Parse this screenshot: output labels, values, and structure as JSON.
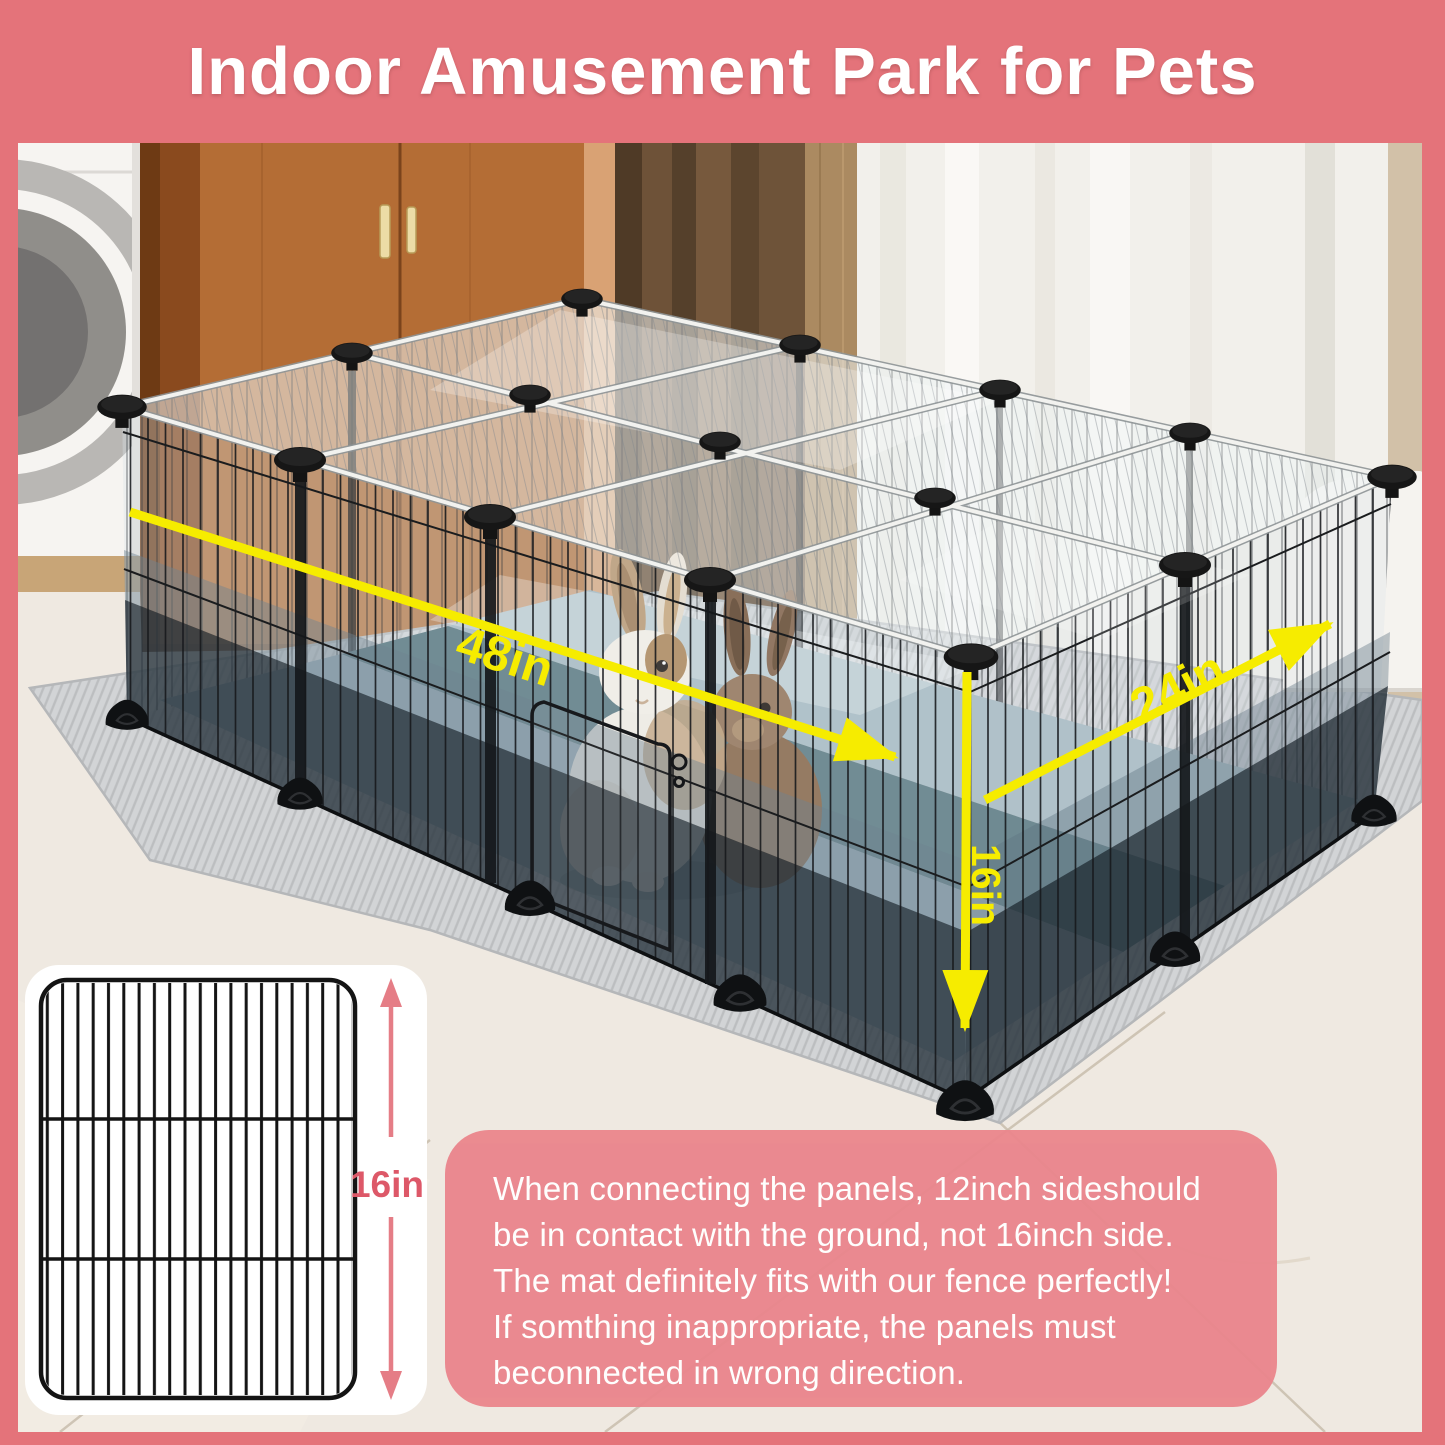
{
  "header": {
    "title": "Indoor Amusement Park for Pets"
  },
  "scene": {
    "dimensions": {
      "length_label": "48in",
      "width_label": "24in",
      "height_label": "16in"
    }
  },
  "panel_inset": {
    "height_label": "16in"
  },
  "note": {
    "lines": [
      "When connecting the panels, 12inch sideshould",
      "be in contact with the ground, not 16inch side.",
      "The mat definitely fits with our fence perfectly!",
      "If somthing inappropriate, the panels must",
      "beconnected in wrong direction."
    ]
  },
  "colors": {
    "frame_pink": "#e4737a",
    "note_pink": "#ea868d",
    "accent_yellow": "#f6ec00",
    "inset_label_pink": "#dd5868"
  }
}
